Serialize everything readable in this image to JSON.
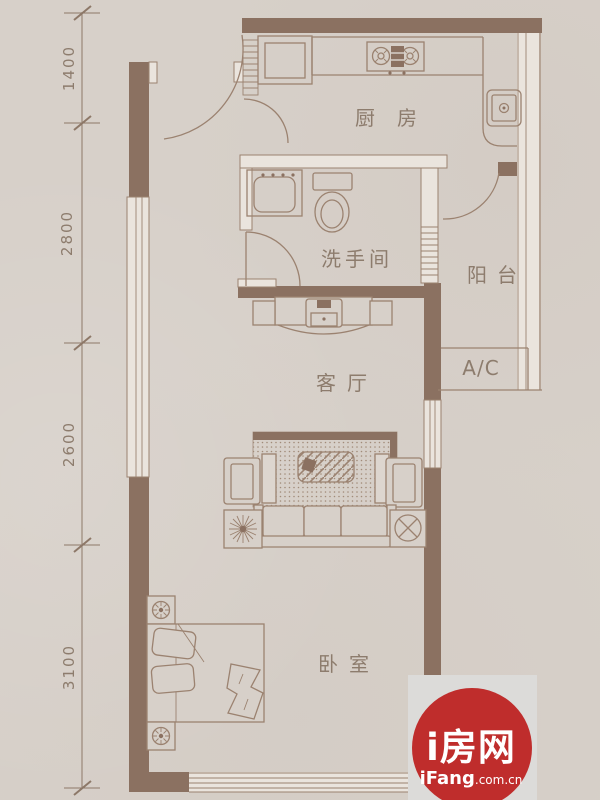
{
  "plan": {
    "type": "apartment-floorplan",
    "rooms": {
      "kitchen": "厨房",
      "bathroom": "洗手间",
      "balcony": "阳台",
      "ac": "A/C",
      "living": "客厅",
      "bedroom": "卧室"
    },
    "dimensions_mm": {
      "d1": "1400",
      "d2": "2800",
      "d3": "2600",
      "d4": "3100"
    },
    "fixtures": [
      "entry-door",
      "kitchen-door",
      "bathroom-door",
      "balcony-door",
      "kitchen-sink",
      "stove",
      "water-heater",
      "washbasin",
      "toilet",
      "tv-cabinet",
      "rug",
      "coffee-table",
      "sofa",
      "armchair-left",
      "armchair-right",
      "plant",
      "fan-table",
      "bed",
      "nightstand-top",
      "nightstand-bottom",
      "window-left",
      "window-bottom",
      "window-right"
    ]
  },
  "watermark": {
    "brand": "i房网",
    "site_bold": "iFang",
    "site_suffix": ".com.cn"
  },
  "colors": {
    "background": "#d7d0c9",
    "wall": "#8b7161",
    "line": "#9b8270",
    "label_text": "#8d7c6d",
    "watermark_red": "#bf2d2c",
    "watermark_card": "#dcdbd9",
    "watermark_text": "#ffffff"
  }
}
